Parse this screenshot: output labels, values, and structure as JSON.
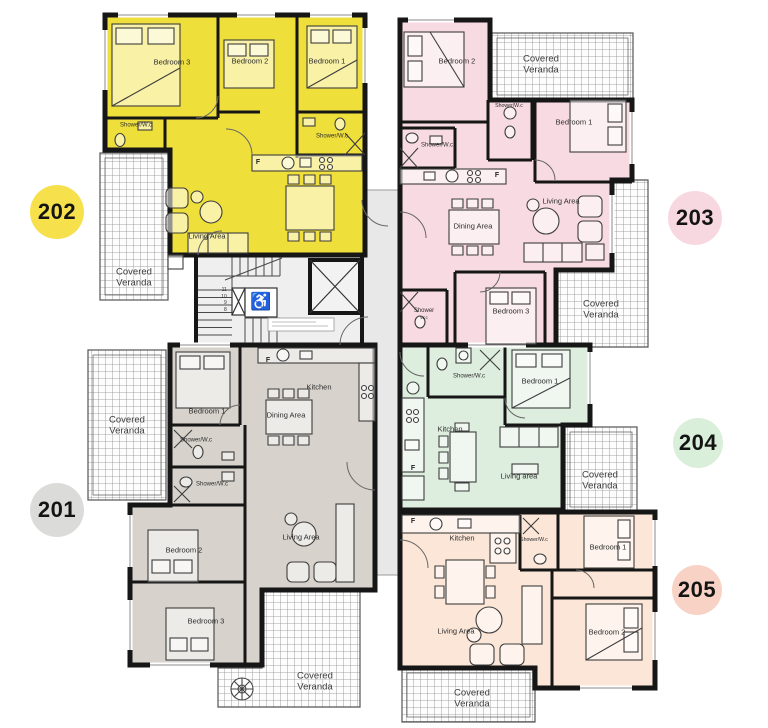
{
  "apartments": {
    "a202": {
      "number": "202",
      "fill": "#efdf3b",
      "badge_color": "#f6e14d",
      "bedroom1": "Bedroom 1",
      "bedroom2": "Bedroom 2",
      "bedroom3": "Bedroom 3",
      "shower_left": "Shower/W.c",
      "shower_right": "Shower/W.c",
      "living": "Living Area",
      "fridge": "F",
      "veranda": "Covered Veranda"
    },
    "a203": {
      "number": "203",
      "fill": "#f8dbe2",
      "badge_color": "#f8d8e0",
      "bedroom1": "Bedroom 1",
      "bedroom2": "Bedroom 2",
      "bedroom3": "Bedroom 3",
      "shower_top": "Shower/W.c",
      "shower_left": "Shower/W.c",
      "shower_bottom": "Shower",
      "shower_bottom_sub": "W.c",
      "dining": "Dining Area",
      "living": "Living Area",
      "fridge": "F",
      "veranda_top": "Covered Veranda",
      "veranda_side": "Covered Veranda"
    },
    "a201": {
      "number": "201",
      "fill": "#d7d3cc",
      "badge_color": "#dbdbd9",
      "bedroom1": "Bedroom 1",
      "bedroom2": "Bedroom 2",
      "bedroom3": "Bedroom 3",
      "shower_upper": "Shower/W.c",
      "shower_lower": "Shower/W.c",
      "kitchen": "Kitchen",
      "dining": "Dining Area",
      "living": "Living Area",
      "fridge": "F",
      "veranda_left": "Covered Veranda",
      "veranda_bottom": "Covered Veranda"
    },
    "a204": {
      "number": "204",
      "fill": "#deeede",
      "badge_color": "#d9efd9",
      "bedroom1": "Bedroom 1",
      "shower": "Shower/W.c",
      "kitchen": "Kitchen",
      "living": "Living area",
      "fridge": "F",
      "veranda": "Covered Veranda"
    },
    "a205": {
      "number": "205",
      "fill": "#fce6d7",
      "badge_color": "#f8d3c5",
      "bedroom1": "Bedroom 1",
      "bedroom2": "Bedroom 2",
      "shower": "Shower/W.c",
      "kitchen": "Kitchen",
      "living": "Living Area",
      "fridge": "F",
      "veranda": "Covered Veranda"
    }
  },
  "core": {
    "fill": "#e8e8e8",
    "stair_fill": "#efefef",
    "steps": [
      "11",
      "10",
      "9",
      "8"
    ],
    "wheelchair_icon": "♿"
  },
  "colors": {
    "wall": "#161616",
    "furniture": "#3d3d3d",
    "hatch_line": "#8a8a8a"
  }
}
